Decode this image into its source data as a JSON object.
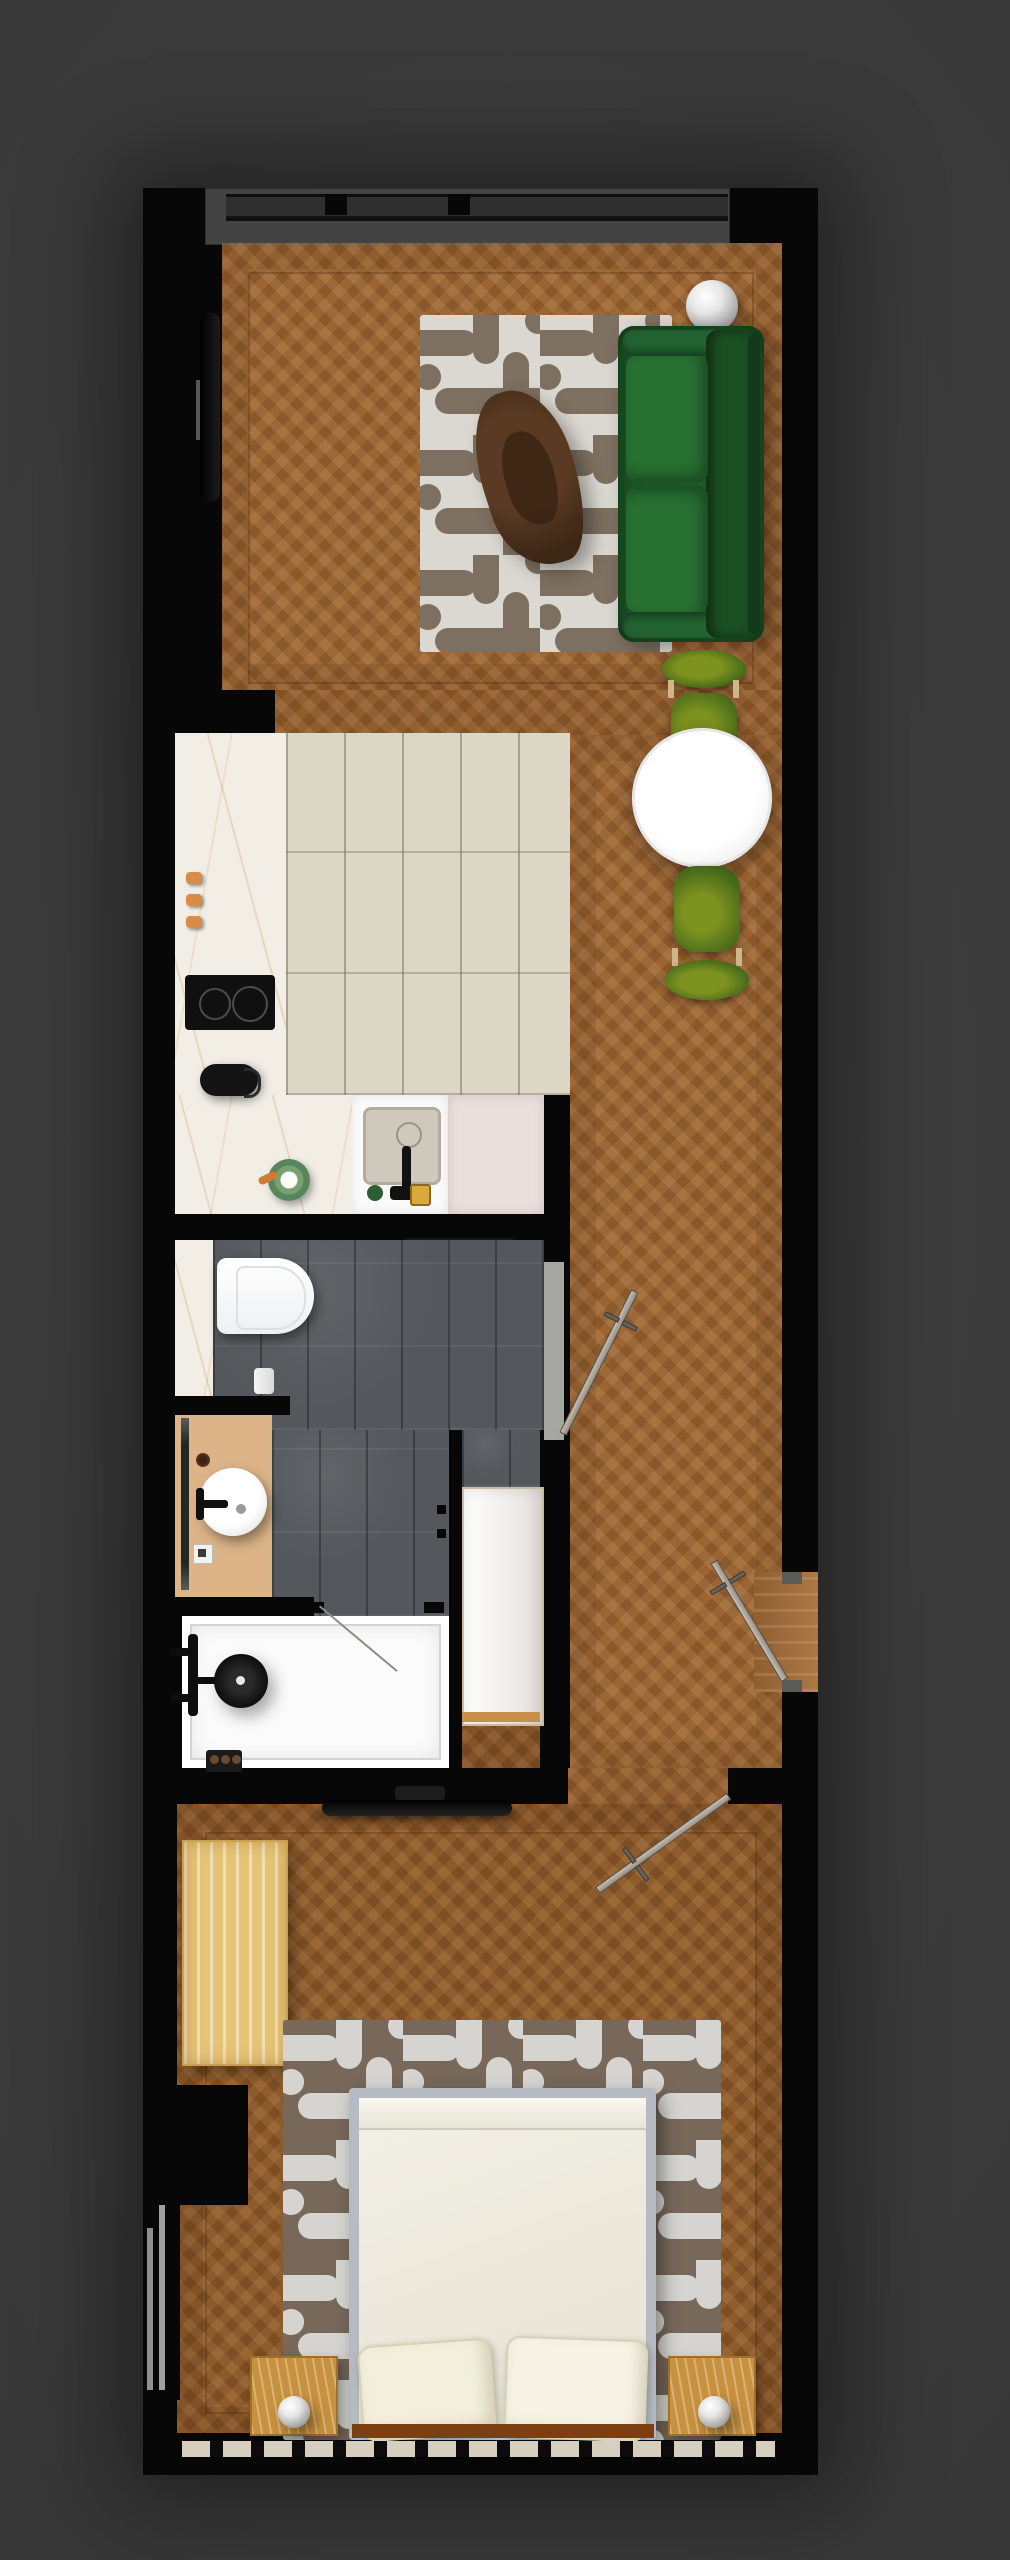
{
  "app": {
    "title": "Apartment floor plan — top-down 3D render"
  },
  "palette": {
    "background": "#383838",
    "wall": "#070707",
    "wood_floor": "#9a6433",
    "wood_floor_dark": "#8d5a2b",
    "kitchen_tile": "#dcd7c5",
    "marble_counter": "#f2eee6",
    "bathroom_tile": "#54585c",
    "vanity_floor": "#dcb488",
    "shower_tray": "#fbfbfb",
    "closet_white": "#f6f5f2",
    "sofa_green": "#1c5926",
    "chair_green": "#5c7b1e",
    "rug_living_base": "#dbd8d1",
    "rug_living_pattern": "#7e7060",
    "rug_bedroom_base": "#77685a",
    "rug_bedroom_pattern": "#d5d4d0",
    "bed_linen": "#efece1",
    "oak_light": "#e5c377",
    "oak_mid": "#c8913f",
    "blush_cabinet": "#ebdfdc",
    "accent_orange": "#d98c46",
    "door_leaf": "#b3aba0",
    "window_frame": "#2e2e2e",
    "terrace_gray": "#434343"
  },
  "rooms": {
    "terrace": {
      "label": "Balcony with window wall"
    },
    "living": {
      "label": "Living room",
      "items": {
        "sofa": "Green three-seat sofa",
        "rug": "Cream maze-pattern rug",
        "coffee_table": "Walnut organic coffee table",
        "floor_lamp": "Chrome sphere floor lamp",
        "tv": "Wall-mounted TV",
        "dining_table": "Round white dining table",
        "chair_top": "Green dining chair",
        "chair_bottom": "Green dining chair"
      }
    },
    "kitchen": {
      "label": "Kitchen",
      "items": {
        "counter": "Marble L-shaped counter",
        "cooktop": "Two-burner hob",
        "kettle": "Black kettle",
        "sink": "Square sink with black faucet",
        "jar": "Green ceramic bowl",
        "hooks": "Copper hooks",
        "cabinet": "Blush lower cabinet",
        "soap": "Soap dispenser",
        "sponge": "Gold sponge"
      }
    },
    "bathroom": {
      "label": "Bathroom",
      "items": {
        "toilet": "Wall-hung toilet",
        "paper": "Toilet-paper roll",
        "vanity": "Vanity nook with round basin",
        "mirror": "Wall mirror strip",
        "shower": "Walk-in shower",
        "shower_head": "Rain shower head",
        "glass": "Glass shower screen",
        "door": "Bathroom door"
      }
    },
    "hall": {
      "label": "Hallway",
      "items": {
        "closet": "Built-in white closet",
        "entry_door": "Entrance door",
        "track": "Sliding-door floor track"
      }
    },
    "bedroom": {
      "label": "Bedroom",
      "items": {
        "bed": "Double bed with white duvet",
        "pillow_left": "Pillow",
        "pillow_right": "Pillow",
        "rug": "Brown maze-pattern rug",
        "wardrobe": "Light-oak wardrobe",
        "nightstand_left": "Nightstand with sphere lamp",
        "nightstand_right": "Nightstand with sphere lamp",
        "tv": "Wall-mounted TV",
        "door": "Bedroom door",
        "window": "Full-width window"
      }
    }
  },
  "counts": {
    "burners": 2,
    "dining_chairs": 2,
    "pillows": 2,
    "nightstands": 2,
    "doors": 3
  }
}
